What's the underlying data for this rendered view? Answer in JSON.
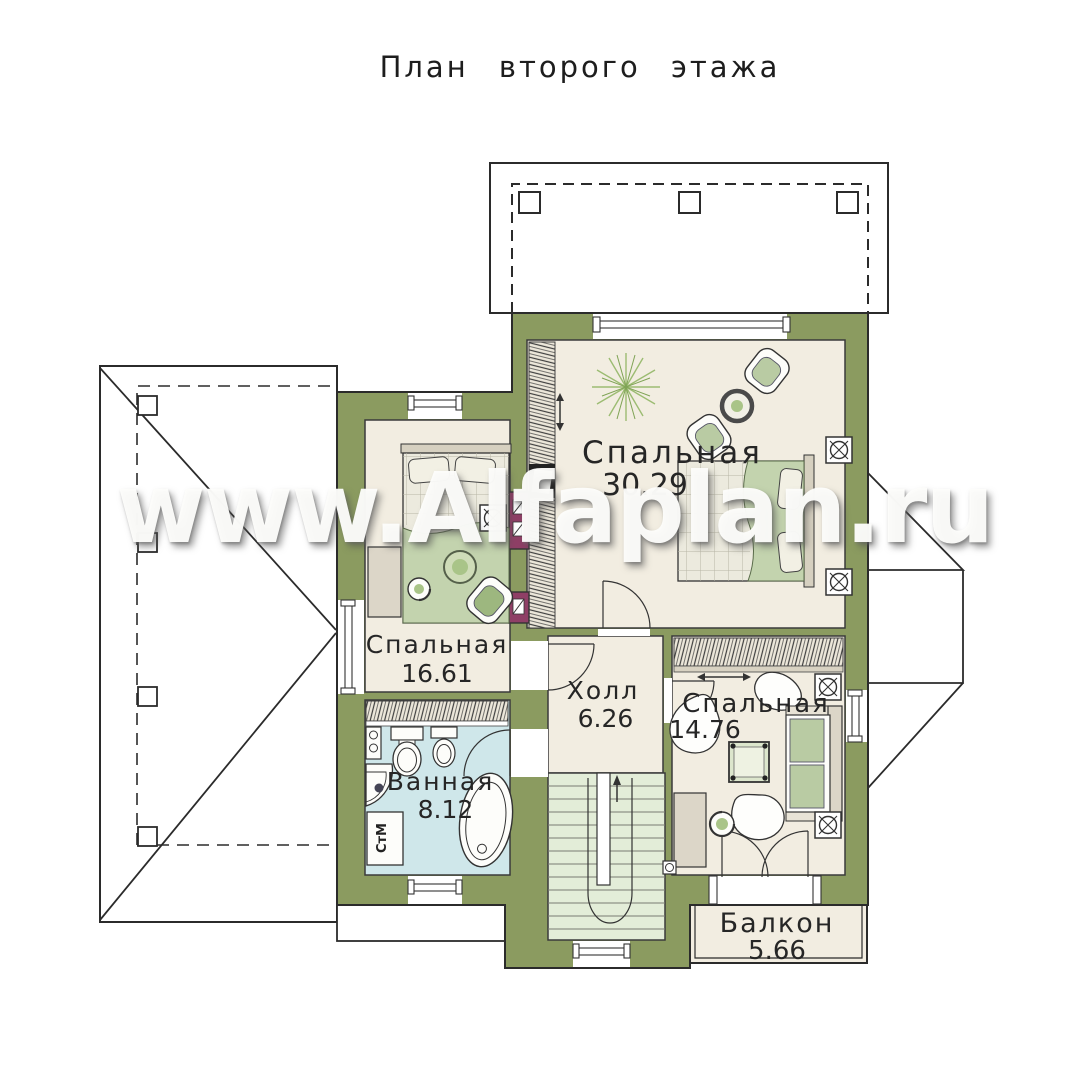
{
  "title": "План второго этажа",
  "watermark": "www.Alfaplan.ru",
  "rooms": [
    {
      "id": "bedroom-30",
      "name": "Спальная",
      "area": "30.29"
    },
    {
      "id": "bedroom-16",
      "name": "Спальная",
      "area": "16.61"
    },
    {
      "id": "hall",
      "name": "Холл",
      "area": "6.26"
    },
    {
      "id": "bedroom-14",
      "name": "Спальная",
      "area": "14.76"
    },
    {
      "id": "bathroom",
      "name": "Ванная",
      "area": "8.12"
    },
    {
      "id": "balcony",
      "name": "Балкон",
      "area": "5.66"
    }
  ],
  "appliances": {
    "washing_machine_label": "СтМ"
  },
  "colors": {
    "wall": "#8b9b60",
    "floor": "#f2ede1",
    "bathroom_floor": "#cfe7ea",
    "stairs_floor": "#e3edd8",
    "vent_shaft": "#8f3f66",
    "line": "#2b2b2b",
    "furniture_green": "#b9cba3"
  }
}
